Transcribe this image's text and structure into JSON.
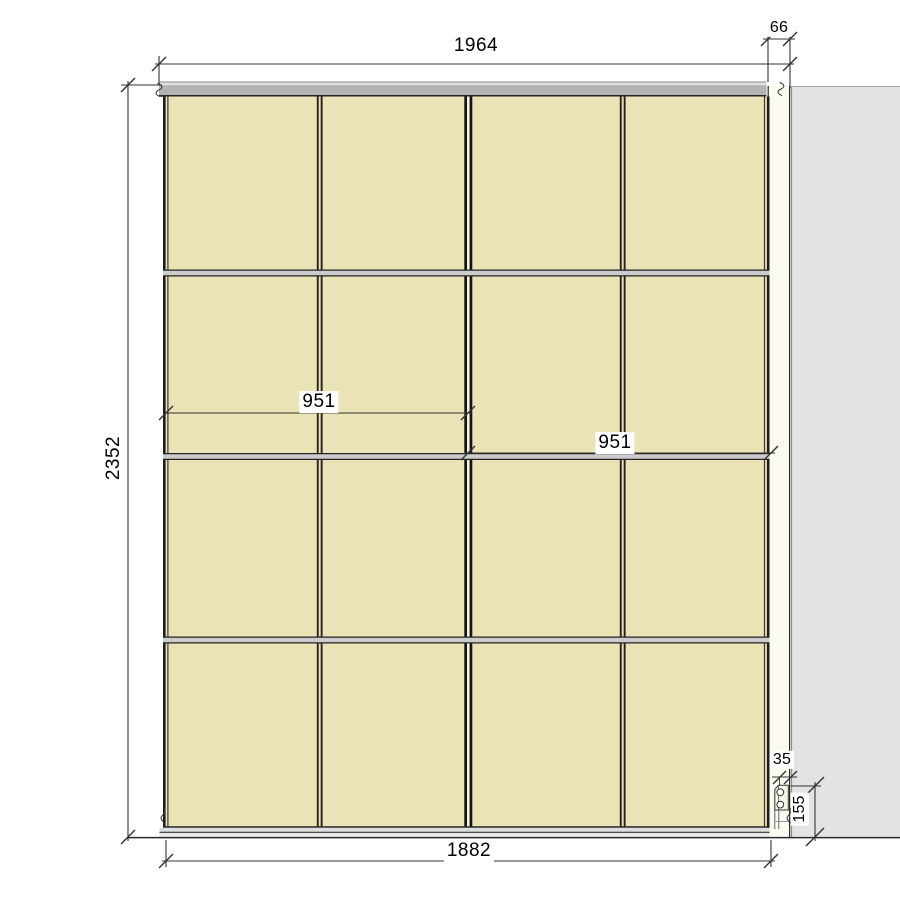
{
  "colors": {
    "background": "#ffffff",
    "panel_fill": "#eae3b5",
    "panel_gap_fill": "#f4f2e2",
    "rail_fill": "#cccccc",
    "top_track_fill": "#b3b3b3",
    "top_track_highlight": "#e0e0e0",
    "bottom_track_fill": "#dddddd",
    "bottom_track_lower_fill": "#ebebeb",
    "wall_fill": "#e3e3e3",
    "filler_fill": "#fbfaf0",
    "bracket_fill": "#f6f5ea",
    "line": "#2a2a2a"
  },
  "dimension_labels": {
    "total_width_mm": "1964",
    "right_gap_mm": "66",
    "total_height_mm": "2352",
    "left_door_width_mm": "951",
    "right_door_width_mm": "951",
    "bracket_width_mm": "35",
    "bracket_height_mm": "155",
    "doors_span_mm": "1882"
  }
}
